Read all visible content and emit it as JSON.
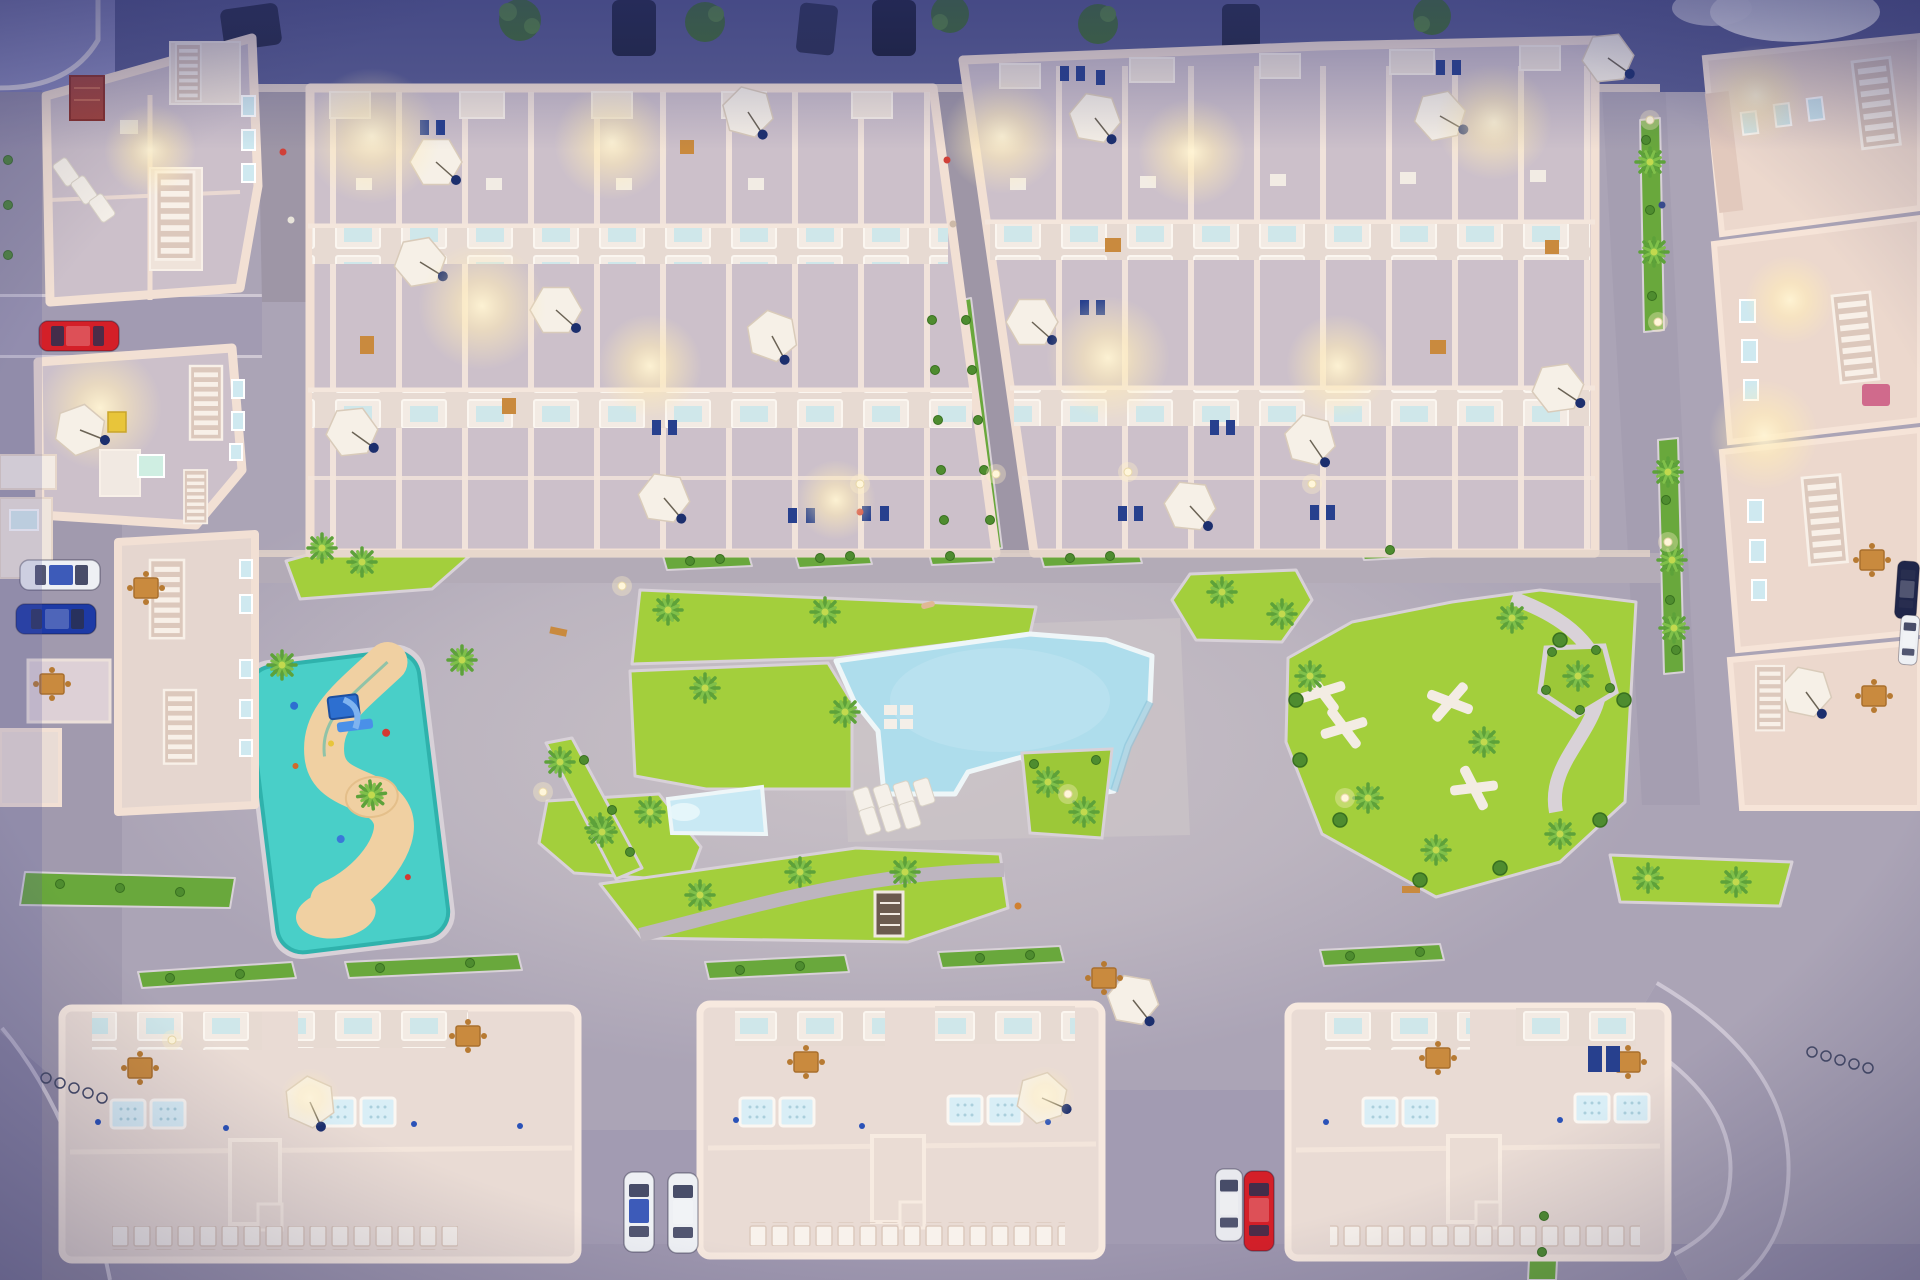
{
  "scene": {
    "type": "aerial-architectural-3d-render",
    "view": "top-down",
    "time_of_day": "dusk",
    "subject": "Residential complex birds-eye rendering with two large roof-terrace apartment blocks at top, three long apartment buildings at bottom, central gardens with large free-form swimming pool, children's pool, turquoise playground and pocket park, perimeter streets with parked cars, street lamps and palm trees"
  },
  "palette": {
    "street_base": "#aba4b6",
    "street_secondary": "#a29bb2",
    "street_top": "#585c91",
    "plaza": "#cdc5c9",
    "walkway": "#9e96a6",
    "terrace_floor": "#ccc0ca",
    "building_wall": "#f2e0d4",
    "building_roof": "#e9dbd4",
    "building_facade": "#e2c9bd",
    "white_structure": "#f6efe8",
    "lawn": "#a3cf3c",
    "hedge": "#69a83c",
    "tree": "#4e8c2f",
    "palm": "#7fc04a",
    "pool_water": "#aeddec",
    "kids_pool": "#c9e9f4",
    "playground_rubber": "#49cfc8",
    "playground_sand": "#f0d0a2",
    "umbrella": "#f6f0e7",
    "jacuzzi": "#d9eef6",
    "wood": "#c98a3e",
    "window_glass": "#cfe9f0",
    "window_dark": "#27408e",
    "car_red": "#d41f28",
    "car_blue": "#1d3aa6",
    "car_white": "#eef0f4",
    "car_dark": "#20264a",
    "glow": "#ffecb8",
    "curb": "#d8d1d8",
    "dark_wedge": "#948da6"
  },
  "areas": {
    "top_street": "Perimeter street at top with dark parked cars and street trees",
    "top_left_buildings": "Corner houses with roof terraces, red rug, sun loungers and stairs",
    "north_block_west": "Roof-terrace apartment block (north-west) with parasols and lit terraces",
    "north_block_east": "Roof-terrace apartment block (north-east) with parasols and lit terraces",
    "pedestrian_walkways": "Paved walkways with hedge borders between blocks",
    "left_buildings": "West perimeter buildings with parked cars and patio furniture",
    "right_buildings": "East perimeter buildings with window facades and white stairs",
    "central_gardens": "Lawn gardens criss-crossed by paths with palm trees",
    "swimming_pool": "Large free-form community pool with steps, island and loungers",
    "kids_pool": "Small children's pool lane",
    "playground": "Turquoise soft-surface playground with sandy winding path and slide",
    "pocket_park": "Park lawn with white X-shaped benches and looping path",
    "south_buildings": "Three long apartment buildings with roof jacuzzis, balcony rows and balustrades",
    "south_streets": "Lower streets with parked cars, vans and bicycle racks"
  },
  "inventory": {
    "apartment_blocks_top": 2,
    "apartment_buildings_bottom": 3,
    "perimeter_building_clusters": 7,
    "swimming_pools": 1,
    "children_pools": 1,
    "playgrounds": 1,
    "pocket_parks": 1,
    "parasols": 20,
    "roof_jacuzzis": 12,
    "cars_parked": 14,
    "bicycle_racks": 2,
    "palm_trees": 32,
    "street_lamps": 12,
    "lit_terraces": 12
  }
}
